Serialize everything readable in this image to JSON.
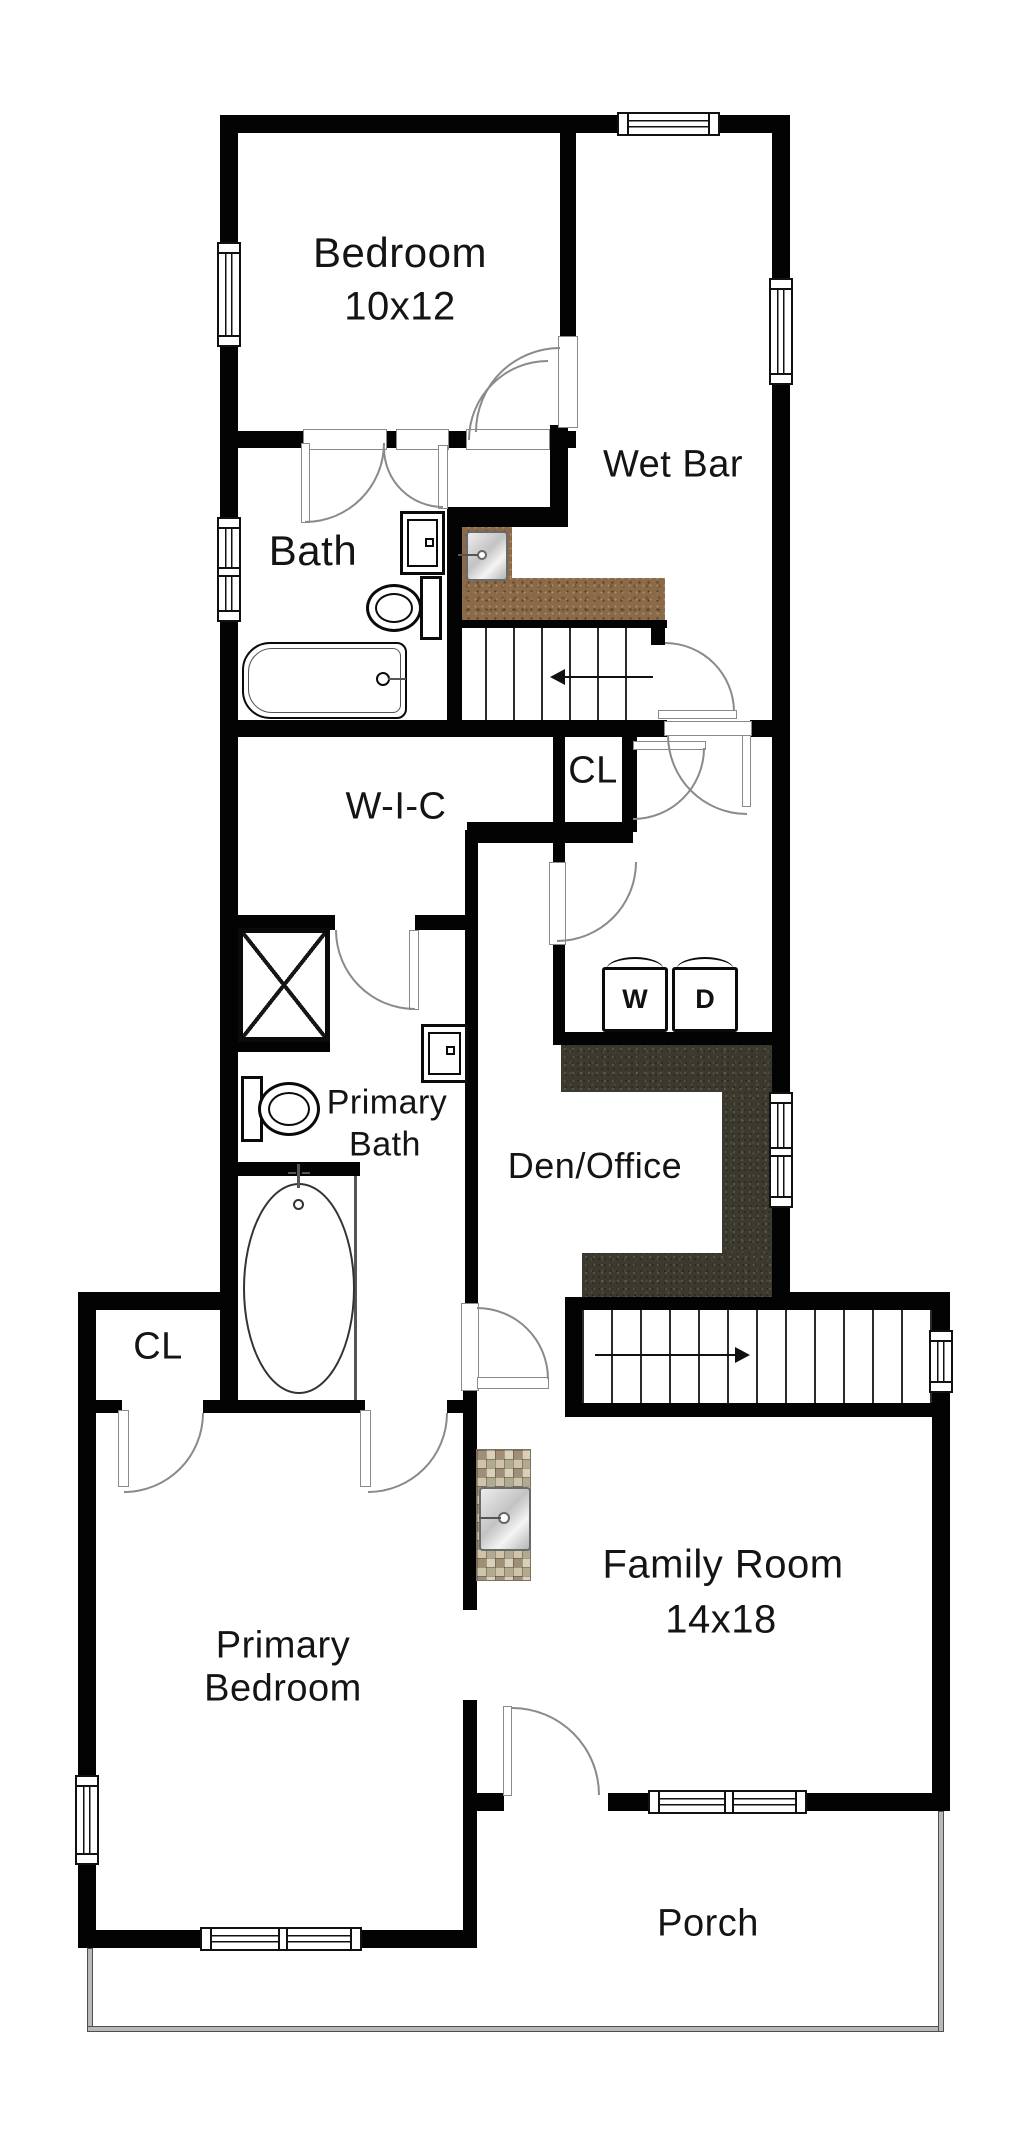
{
  "plan_type": "residential floor plan",
  "colors": {
    "wall": "#030303",
    "door_swing": "#8a8a8a",
    "counter_wood": "#8a6a48",
    "counter_granite": "#3c392e",
    "tile_mosaic": "#c9bfa6",
    "porch_wall": "#b9b9b9"
  },
  "rooms": {
    "bedroom": {
      "name": "Bedroom",
      "dims": "10x12"
    },
    "wet_bar": {
      "name": "Wet Bar"
    },
    "bath": {
      "name": "Bath"
    },
    "closet_hall": {
      "name": "CL"
    },
    "wic": {
      "name": "W-I-C"
    },
    "primary_bath": {
      "line1": "Primary",
      "line2": "Bath"
    },
    "den_office": {
      "name": "Den/Office"
    },
    "closet_bedroom": {
      "name": "CL"
    },
    "primary_bedroom": {
      "line1": "Primary",
      "line2": "Bedroom"
    },
    "family_room": {
      "name": "Family Room",
      "dims": "14x18"
    },
    "porch": {
      "name": "Porch"
    }
  },
  "appliances": {
    "washer": "W",
    "dryer": "D"
  },
  "icons": {
    "stairs_up_arrow": "left-arrow",
    "stairs_down_arrow": "right-arrow"
  }
}
